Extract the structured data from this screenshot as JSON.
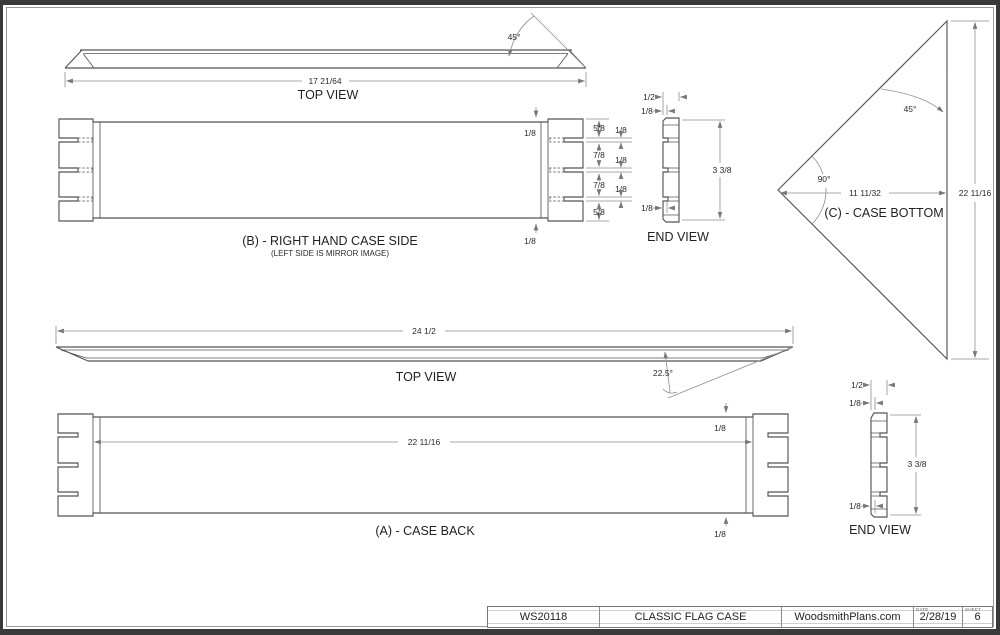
{
  "views": {
    "top_view_b": {
      "title": "TOP VIEW",
      "dim_length": "17 21/64",
      "angle": "45°"
    },
    "side_b": {
      "title": "(B) - RIGHT HAND CASE SIDE",
      "subtitle": "(LEFT SIDE IS MIRROR IMAGE)",
      "dim_lip_top": "1/8",
      "dim_lip_bottom": "1/8",
      "dim_segments": [
        "5/8",
        "7/8",
        "7/8",
        "5/8"
      ],
      "dim_grooves": [
        "1/8",
        "1/8",
        "1/8"
      ]
    },
    "end_view_b": {
      "title": "END VIEW",
      "dim_width": "1/2",
      "dim_lip_top": "1/8",
      "dim_height": "3 3/8",
      "dim_lip_bottom": "1/8"
    },
    "bottom_c": {
      "title": "(C) - CASE BOTTOM",
      "angle_top": "45°",
      "angle_corner": "90°",
      "dim_width": "11 11/32",
      "dim_height": "22 11/16"
    },
    "top_view_a": {
      "title": "TOP VIEW",
      "dim_length": "24 1/2",
      "angle": "22.5°"
    },
    "back_a": {
      "title": "(A) - CASE BACK",
      "dim_width": "22 11/16",
      "dim_lip_top": "1/8",
      "dim_lip_bottom": "1/8"
    },
    "end_view_a": {
      "title": "END VIEW",
      "dim_width": "1/2",
      "dim_lip_top": "1/8",
      "dim_height": "3 3/8",
      "dim_lip_bottom": "1/8"
    }
  },
  "title_block": {
    "plan_number": "WS20118",
    "plan_title": "CLASSIC FLAG CASE",
    "website": "WoodsmithPlans.com",
    "date_label": "DATE",
    "date": "2/28/19",
    "sheet_label": "SHEET",
    "sheet": "6"
  }
}
